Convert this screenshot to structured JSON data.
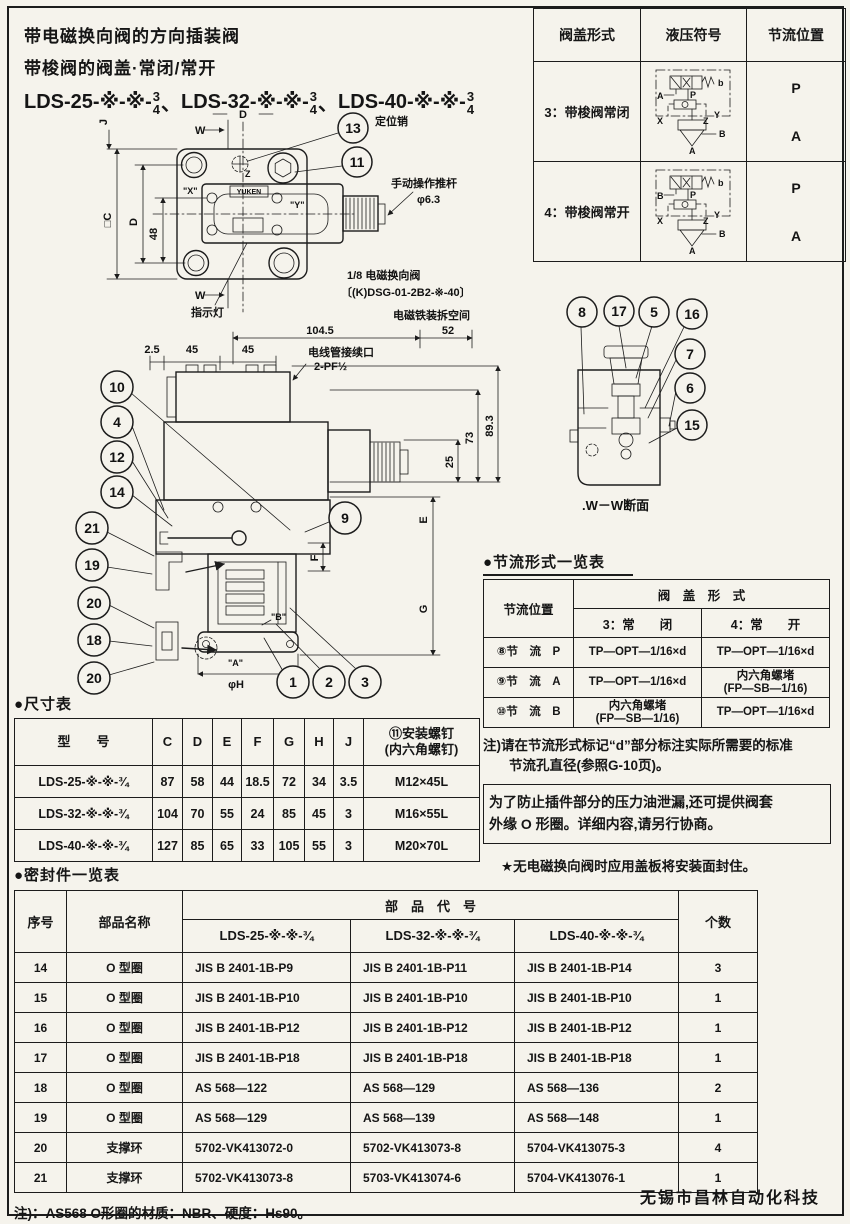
{
  "header": {
    "line1": "带电磁换向阀的方向插装阀",
    "line2": "带梭阀的阀盖·常闭/常开",
    "models": [
      {
        "prefix": "LDS-25-※-※-",
        "num": "3",
        "den": "4",
        "sep": "、"
      },
      {
        "prefix": "LDS-32-※-※-",
        "num": "3",
        "den": "4",
        "sep": "、"
      },
      {
        "prefix": "LDS-40-※-※-",
        "num": "3",
        "den": "4",
        "sep": ""
      }
    ]
  },
  "cover_table": {
    "col_form": "阀盖形式",
    "col_symbol": "液压符号",
    "col_throttle": "节流位置",
    "rows": [
      {
        "form": "3：带梭阀常闭",
        "p": "P",
        "a": "A",
        "left_port": "A"
      },
      {
        "form": "4：带梭阀常开",
        "p": "P",
        "a": "A",
        "left_port": "B"
      }
    ],
    "sym": {
      "b": "b",
      "p": "P",
      "x": "X",
      "z": "Z",
      "y": "Y",
      "bport": "B",
      "aport": "A"
    }
  },
  "top_view": {
    "callout_13": "13",
    "callout_11": "11",
    "pin_label": "定位销",
    "rod_label": "手动操作推杆",
    "rod_dia": "φ6.3",
    "indicator_label": "指示灯",
    "valve_note1": "1/8 电磁换向阀",
    "valve_note2": "〔(K)DSG-01-2B2-※-40〕",
    "removal_label": "电磁铁装拆空间",
    "brand": "YUKEN",
    "dim_w_top": "W",
    "dim_w_bottom": "W",
    "dim_d_top": "D",
    "dim_j": "J",
    "dim_c": "□C",
    "dim_d_left": "D",
    "dim_48": "48",
    "port_x": "\"X\"",
    "port_y": "\"Y\"",
    "port_z": "Z"
  },
  "section_view": {
    "dim_104": "104.5",
    "dim_52": "52",
    "dim_2_5": "2.5",
    "dim_45a": "45",
    "dim_45b": "45",
    "conduit1": "电线管接续口",
    "conduit2": "2-PF½",
    "dim_25": "25",
    "dim_73": "73",
    "dim_89": "89.3",
    "dim_e": "E",
    "dim_f": "F",
    "dim_g": "G",
    "dim_phih": "φH",
    "port_a": "\"A\"",
    "port_b": "\"B\"",
    "callouts_left_top": [
      "10",
      "4",
      "12",
      "14"
    ],
    "callouts_left_bottom": [
      "21",
      "19",
      "20",
      "18",
      "20"
    ],
    "callout_mid": "9",
    "callouts_bottom": [
      "1",
      "2",
      "3"
    ]
  },
  "ww_view": {
    "callouts_top": [
      "8",
      "17",
      "5",
      "16"
    ],
    "callouts_right": [
      "7",
      "6",
      "15"
    ],
    "label": ".W－W断面"
  },
  "throttle": {
    "heading": "●节流形式一览表",
    "col_pos": "节流位置",
    "col_cover": "阀　盖　形　式",
    "sub_closed": "3：常　　闭",
    "sub_open": "4：常　　开",
    "rows": [
      [
        "⑧节　流　P",
        "TP—OPT—1/16×d",
        "TP—OPT—1/16×d"
      ],
      [
        "⑨节　流　A",
        "TP—OPT—1/16×d",
        "内六角螺堵\n(FP—SB—1/16)"
      ],
      [
        "⑩节　流　B",
        "内六角螺堵\n(FP—SB—1/16)",
        "TP—OPT—1/16×d"
      ]
    ],
    "note1": "注)请在节流形式标记“d”部分标注实际所需要的标准",
    "note2": "节流孔直径(参照G-10页)。",
    "boxed1": "为了防止插件部分的压力油泄漏,还可提供阀套",
    "boxed2": "外缘 O 形圈。详细内容,请另行协商。",
    "star": "★无电磁换向阀时应用盖板将安装面封住。"
  },
  "size_table": {
    "heading": "●尺寸表",
    "col_model": "型　　号",
    "cols": [
      "C",
      "D",
      "E",
      "F",
      "G",
      "H",
      "J"
    ],
    "col_screw": "⑪安装螺钉\n(内六角螺钉)",
    "rows": [
      [
        "LDS-25-※-※-¾",
        "87",
        "58",
        "44",
        "18.5",
        "72",
        "34",
        "3.5",
        "M12×45L"
      ],
      [
        "LDS-32-※-※-¾",
        "104",
        "70",
        "55",
        "24",
        "85",
        "45",
        "3",
        "M16×55L"
      ],
      [
        "LDS-40-※-※-¾",
        "127",
        "85",
        "65",
        "33",
        "105",
        "55",
        "3",
        "M20×70L"
      ]
    ]
  },
  "seal_table": {
    "heading": "●密封件一览表",
    "col_no": "序号",
    "col_name": "部品名称",
    "col_code": "部　品　代　号",
    "col_qty": "个数",
    "code_cols": [
      "LDS-25-※-※-¾",
      "LDS-32-※-※-¾",
      "LDS-40-※-※-¾"
    ],
    "rows": [
      [
        "14",
        "O 型圈",
        "JIS B 2401-1B-P9",
        "JIS B 2401-1B-P11",
        "JIS B 2401-1B-P14",
        "3"
      ],
      [
        "15",
        "O 型圈",
        "JIS B 2401-1B-P10",
        "JIS B 2401-1B-P10",
        "JIS B 2401-1B-P10",
        "1"
      ],
      [
        "16",
        "O 型圈",
        "JIS B 2401-1B-P12",
        "JIS B 2401-1B-P12",
        "JIS B 2401-1B-P12",
        "1"
      ],
      [
        "17",
        "O 型圈",
        "JIS B 2401-1B-P18",
        "JIS B 2401-1B-P18",
        "JIS B 2401-1B-P18",
        "1"
      ],
      [
        "18",
        "O 型圈",
        "AS 568—122",
        "AS 568—129",
        "AS 568—136",
        "2"
      ],
      [
        "19",
        "O 型圈",
        "AS 568—129",
        "AS 568—139",
        "AS 568—148",
        "1"
      ],
      [
        "20",
        "支撑环",
        "5702-VK413072-0",
        "5702-VK413073-8",
        "5704-VK413075-3",
        "4"
      ],
      [
        "21",
        "支撑环",
        "5702-VK413073-8",
        "5703-VK413074-6",
        "5704-VK413076-1",
        "1"
      ]
    ],
    "note": "注)：AS568 O形圈的材质：NBR、硬度：Hs90。"
  },
  "footer": "无锡市昌林自动化科技"
}
